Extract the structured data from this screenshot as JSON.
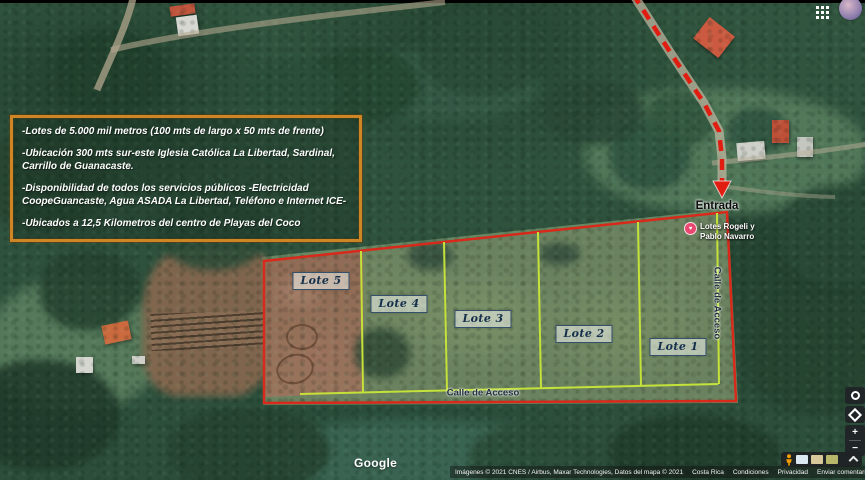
{
  "info_box": {
    "paragraphs": [
      "-Lotes de 5.000 mil metros (100 mts de largo x 50 mts de frente)",
      "-Ubicación 300 mts sur-este Iglesia Católica La Libertad, Sardinal, Carrillo de Guanacaste.",
      "-Disponibilidad de todos los servicios públicos -Electricidad CoopeGuancaste, Agua ASADA La Libertad, Teléfono e Internet ICE-",
      "-Ubicados a 12,5 Kilometros del centro de Playas del Coco"
    ]
  },
  "map": {
    "lots": [
      "Lote 5",
      "Lote 4",
      "Lote 3",
      "Lote 2",
      "Lote 1"
    ],
    "entrance_label": "Entrada",
    "road_label_bottom": "Calle de Acceso",
    "road_label_right": "Calle de Acceso",
    "place_marker": {
      "line1": "Lotes Rogeli y",
      "line2": "Pablo Navarro"
    },
    "colors": {
      "boundary_red": "#d8291a",
      "divider_yellow": "#c4e23a",
      "arrow_red": "#e01d10",
      "info_border_orange": "#cd8526"
    }
  },
  "google_ui": {
    "logo": "Google",
    "attribution": "Imágenes © 2021 CNES / Airbus, Maxar Technologies, Datos del mapa © 2021",
    "links": [
      "Costa Rica",
      "Condiciones",
      "Privacidad",
      "Enviar comentario"
    ],
    "scale_label": "20 m",
    "zoom_in_label": "+",
    "zoom_out_label": "−"
  }
}
